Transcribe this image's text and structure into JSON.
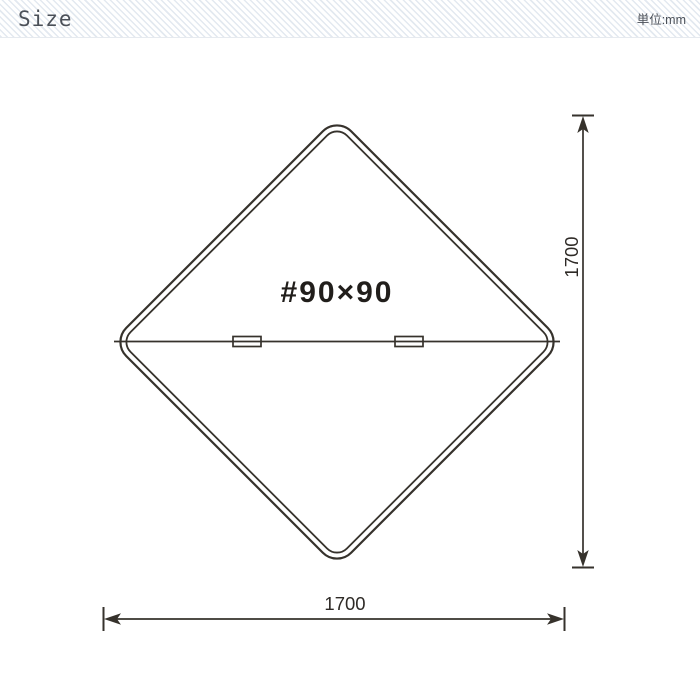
{
  "header": {
    "title": "Size",
    "unit_label": "単位:mm"
  },
  "diagram": {
    "center_label": "#90×90",
    "width_label": "1700",
    "height_label": "1700"
  },
  "colors": {
    "line": "#36322c",
    "center_label_text": "#211e1b",
    "dimension_text": "#2e2a26",
    "header_text": "#4b5058",
    "header_stripe": "#e3e9f0",
    "background": "#ffffff"
  }
}
